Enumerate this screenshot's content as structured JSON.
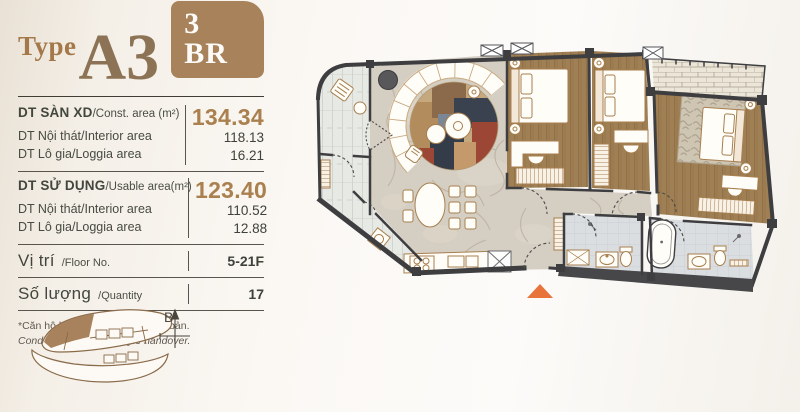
{
  "header": {
    "type_label": "Type",
    "unit_code": "A3",
    "bedrooms_badge": "3 BR"
  },
  "area_table": {
    "groups": [
      {
        "label_vn": "DT SÀN XD",
        "label_en": "/Const. area (m²)",
        "value": "134.34",
        "rows": [
          {
            "label_vn": "DT Nội thát",
            "label_en": "/Interior area",
            "value": "118.13"
          },
          {
            "label_vn": "DT Lô gia",
            "label_en": "/Loggia area",
            "value": "16.21"
          }
        ]
      },
      {
        "label_vn": "DT SỬ DỤNG",
        "label_en": "/Usable area(m²)",
        "value": "123.40",
        "rows": [
          {
            "label_vn": "DT Nội thát",
            "label_en": "/Interior area",
            "value": "110.52"
          },
          {
            "label_vn": "DT Lô gia",
            "label_en": "/Loggia area",
            "value": "12.88"
          }
        ]
      }
    ],
    "floor_row": {
      "label_vn": "Vị trí",
      "label_en": "/Floor No.",
      "value": "5-21F"
    },
    "quantity_row": {
      "label_vn": "Số lượng",
      "label_en": "/Quantity",
      "value": "17"
    }
  },
  "footnote": {
    "line_vn": "*Căn hộ bàn giao hoàn thiện cơ bản.",
    "line_en": "Condos are standard-style handover."
  },
  "minimap": {
    "compass_label": "B"
  },
  "icons": {
    "compass_arrow": "north-arrow",
    "entrance_marker": "orange-triangle",
    "window_marker": "x-box"
  },
  "colors": {
    "accent_brown": "#A5784A",
    "badge_brown": "#A8825B",
    "number_brown": "#A9804E",
    "text_dark": "#3F4339",
    "wall": "#3E3E40",
    "wood_floor": "#9B7B4F",
    "marble_floor": "#D5CEC2",
    "balcony_tile": "#E7E9E5",
    "bath_tile": "#DBDEE1",
    "entrance_orange": "#E8743C"
  }
}
